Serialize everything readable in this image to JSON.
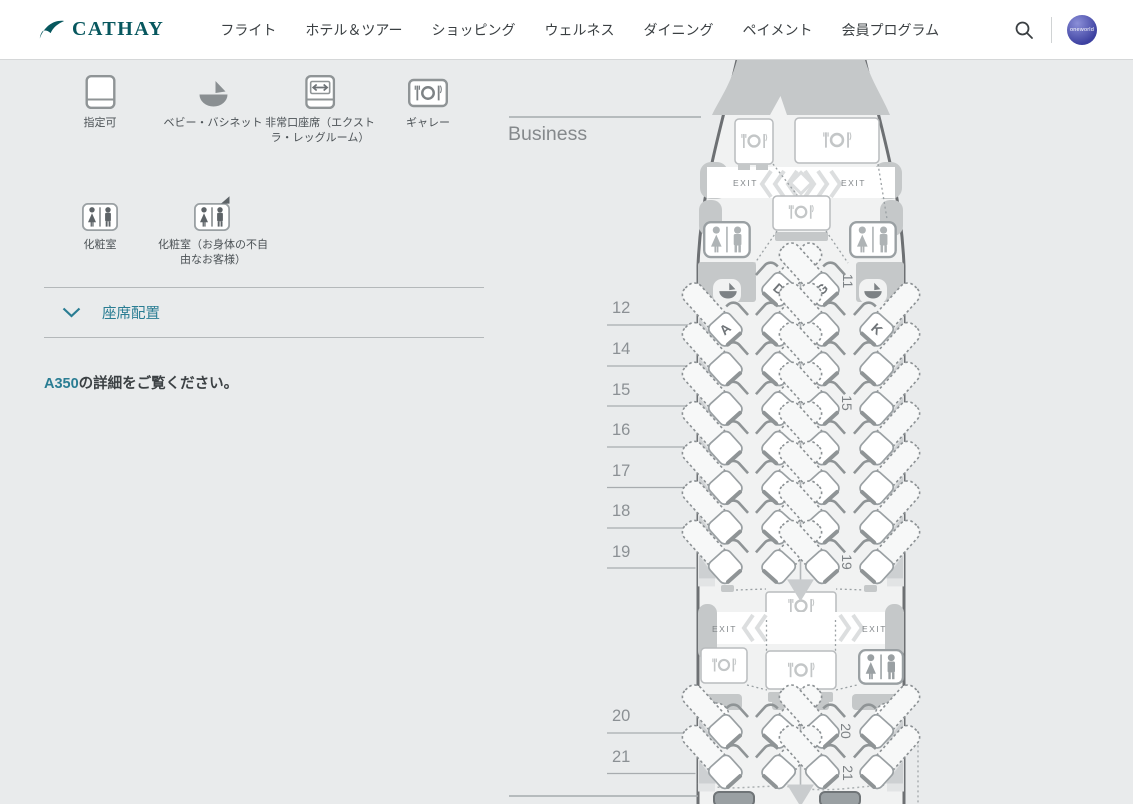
{
  "header": {
    "brand": "CATHAY",
    "nav": [
      "フライト",
      "ホテル＆ツアー",
      "ショッピング",
      "ウェルネス",
      "ダイニング",
      "ペイメント",
      "会員プログラム"
    ],
    "oneworld": "oneworld"
  },
  "legend": {
    "rows": [
      [
        {
          "icon": "seat-available-icon",
          "label": "指定可"
        },
        {
          "icon": "bassinet-icon",
          "label": "ベビー・バシネット"
        },
        {
          "icon": "exit-row-seat-icon",
          "label": "非常口座席（エクスト\nラ・レッグルーム）"
        },
        {
          "icon": "galley-icon",
          "label": "ギャレー"
        }
      ],
      [
        {
          "icon": "lavatory-icon",
          "label": "化粧室"
        },
        {
          "icon": "accessible-lavatory-icon",
          "label": "化粧室（お身体の不自\n由なお客様）"
        }
      ]
    ]
  },
  "accordion": {
    "label": "座席配置"
  },
  "note": {
    "link": "A350",
    "text": "の詳細をご覧ください。"
  },
  "seat_map": {
    "cabin_label": "Business",
    "next_cabin_label": "Premium",
    "exit_label": "EXIT",
    "columns": {
      "A": 725,
      "D": 779,
      "G": 822,
      "K": 877
    },
    "left_rows": [
      [
        "12",
        307,
        325
      ],
      [
        "14",
        348,
        366
      ],
      [
        "15",
        389,
        406
      ],
      [
        "16",
        429,
        447
      ],
      [
        "17",
        470,
        487.5
      ],
      [
        "18",
        510,
        528
      ],
      [
        "19",
        551,
        568
      ],
      [
        "20",
        715,
        733
      ],
      [
        "21",
        756,
        773.5
      ]
    ],
    "map_labels": [
      [
        "11",
        848,
        281
      ],
      [
        "15",
        847,
        403
      ],
      [
        "19",
        847,
        562
      ],
      [
        "20",
        846,
        731
      ],
      [
        "21",
        848,
        773
      ]
    ],
    "rows": [
      {
        "num": "11",
        "y": 289,
        "seats": [
          "D",
          "G"
        ],
        "letters": {
          "D": "D",
          "G": "G"
        }
      },
      {
        "num": "12",
        "y": 329,
        "seats": [
          "A",
          "D",
          "G",
          "K"
        ],
        "letters": {
          "A": "A",
          "K": "K"
        }
      },
      {
        "num": "14",
        "y": 368.6,
        "seats": [
          "A",
          "D",
          "G",
          "K"
        ]
      },
      {
        "num": "15",
        "y": 408.2,
        "seats": [
          "A",
          "D",
          "G",
          "K"
        ]
      },
      {
        "num": "16",
        "y": 447.7,
        "seats": [
          "A",
          "D",
          "G",
          "K"
        ]
      },
      {
        "num": "17",
        "y": 487.3,
        "seats": [
          "A",
          "D",
          "G",
          "K"
        ]
      },
      {
        "num": "18",
        "y": 526.9,
        "seats": [
          "A",
          "D",
          "G",
          "K"
        ]
      },
      {
        "num": "19",
        "y": 566.4,
        "seats": [
          "A",
          "D",
          "G",
          "K"
        ]
      },
      {
        "num": "20",
        "y": 731,
        "seats": [
          "A",
          "D",
          "G",
          "K"
        ]
      },
      {
        "num": "21",
        "y": 771.5,
        "seats": [
          "A",
          "D",
          "G",
          "K"
        ]
      }
    ]
  },
  "colors": {
    "brand_teal": "#07575e",
    "link_teal": "#2a7d93",
    "page_bg": "#e9ebec",
    "header_bg": "#ffffff",
    "nav_text": "#3a3f42",
    "map_outline": "#6d7073",
    "map_gray": "#c5c8c9",
    "oneworld_blue": "#4347a2"
  }
}
